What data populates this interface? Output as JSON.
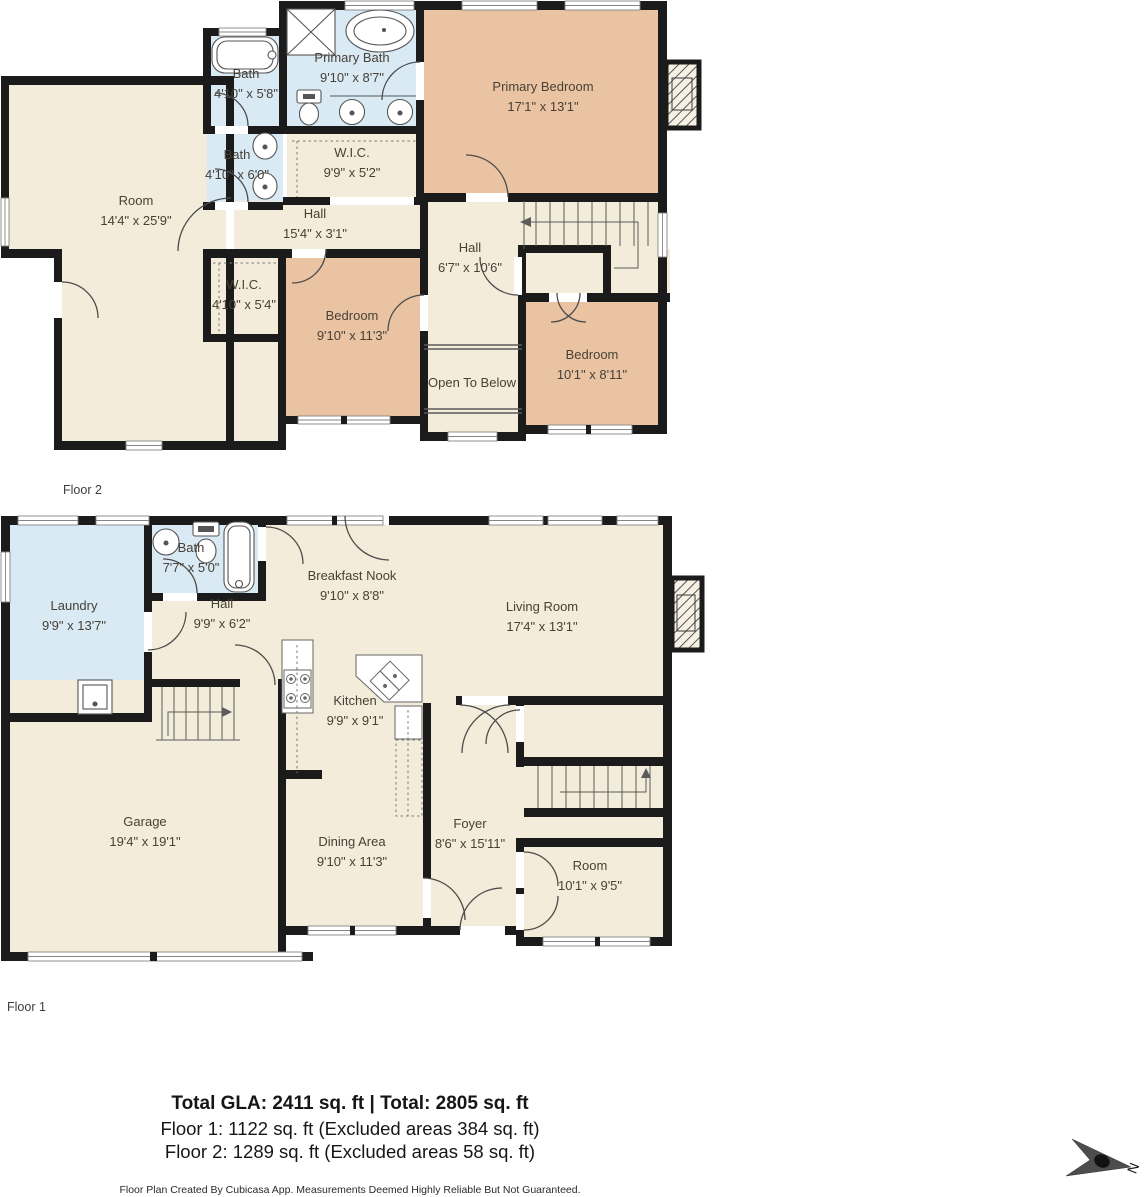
{
  "floor2": {
    "label": "Floor 2",
    "rooms": {
      "bath_top": {
        "name": "Bath",
        "dims": "4'10\" x 5'8\""
      },
      "primary_bath": {
        "name": "Primary Bath",
        "dims": "9'10\" x 8'7\""
      },
      "primary_bedroom": {
        "name": "Primary Bedroom",
        "dims": "17'1\" x 13'1\""
      },
      "room": {
        "name": "Room",
        "dims": "14'4\" x 25'9\""
      },
      "bath_mid": {
        "name": "Bath",
        "dims": "4'10\" x 6'0\""
      },
      "wic1": {
        "name": "W.I.C.",
        "dims": "9'9\" x 5'2\""
      },
      "hall_h": {
        "name": "Hall",
        "dims": "15'4\" x 3'1\""
      },
      "hall_v": {
        "name": "Hall",
        "dims": "6'7\" x 10'6\""
      },
      "wic2": {
        "name": "W.I.C.",
        "dims": "4'10\" x 5'4\""
      },
      "bedroom1": {
        "name": "Bedroom",
        "dims": "9'10\" x 11'3\""
      },
      "open_below": {
        "name": "Open To Below"
      },
      "bedroom2": {
        "name": "Bedroom",
        "dims": "10'1\" x 8'11\""
      }
    }
  },
  "floor1": {
    "label": "Floor 1",
    "rooms": {
      "laundry": {
        "name": "Laundry",
        "dims": "9'9\" x 13'7\""
      },
      "bath": {
        "name": "Bath",
        "dims": "7'7\" x 5'0\""
      },
      "hall": {
        "name": "Hall",
        "dims": "9'9\" x 6'2\""
      },
      "nook": {
        "name": "Breakfast Nook",
        "dims": "9'10\" x 8'8\""
      },
      "living": {
        "name": "Living Room",
        "dims": "17'4\" x 13'1\""
      },
      "kitchen": {
        "name": "Kitchen",
        "dims": "9'9\" x 9'1\""
      },
      "garage": {
        "name": "Garage",
        "dims": "19'4\" x 19'1\""
      },
      "dining": {
        "name": "Dining Area",
        "dims": "9'10\" x 11'3\""
      },
      "foyer": {
        "name": "Foyer",
        "dims": "8'6\" x 15'11\""
      },
      "room": {
        "name": "Room",
        "dims": "10'1\" x 9'5\""
      }
    }
  },
  "summary": {
    "total": "Total GLA: 2411 sq. ft | Total: 2805 sq. ft",
    "floor1": "Floor 1: 1122 sq. ft (Excluded areas 384 sq. ft)",
    "floor2": "Floor 2: 1289 sq. ft (Excluded areas 58 sq. ft)"
  },
  "disclaimer": "Floor Plan Created By Cubicasa App. Measurements Deemed Highly Reliable But Not Guaranteed.",
  "compass": {
    "label": "N"
  },
  "colors": {
    "wall": "#1b1b1b",
    "room_fill": "#f3ecda",
    "bedroom_fill": "#eac4a2",
    "bath_fill": "#d9eaf4",
    "line": "#4a4a4a"
  }
}
